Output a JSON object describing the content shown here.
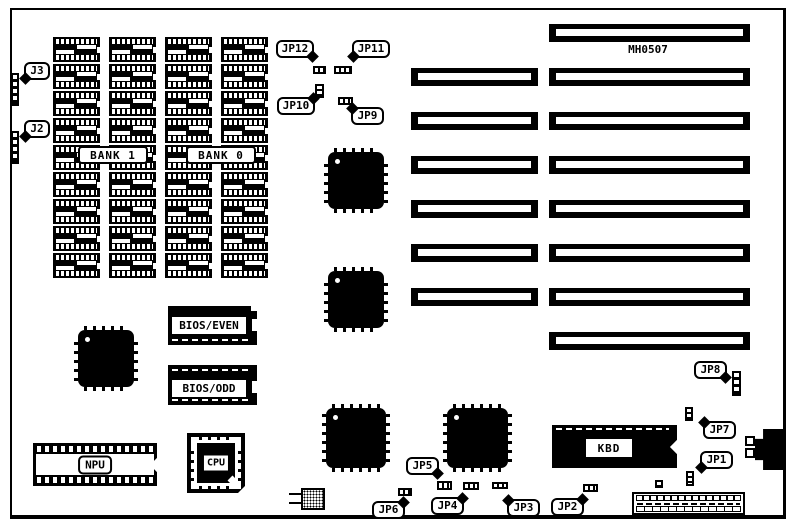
{
  "board_label": "MH0507",
  "memory": {
    "rows": 9,
    "cols": 4,
    "bank_labels": {
      "bank1": "BANK 1",
      "bank0": "BANK 0"
    }
  },
  "slots": {
    "left_count": 6,
    "right_count": 8
  },
  "chips": {
    "bios_even": "BIOS/EVEN",
    "bios_odd": "BIOS/ODD",
    "npu": "NPU",
    "cpu": "CPU",
    "kbd": "KBD"
  },
  "callouts": {
    "j3": "J3",
    "j2": "J2",
    "jp1": "JP1",
    "jp2": "JP2",
    "jp3": "JP3",
    "jp4": "JP4",
    "jp5": "JP5",
    "jp6": "JP6",
    "jp7": "JP7",
    "jp8": "JP8",
    "jp9": "JP9",
    "jp10": "JP10",
    "jp11": "JP11",
    "jp12": "JP12"
  },
  "colors": {
    "ink": "#000000",
    "paper": "#ffffff"
  }
}
